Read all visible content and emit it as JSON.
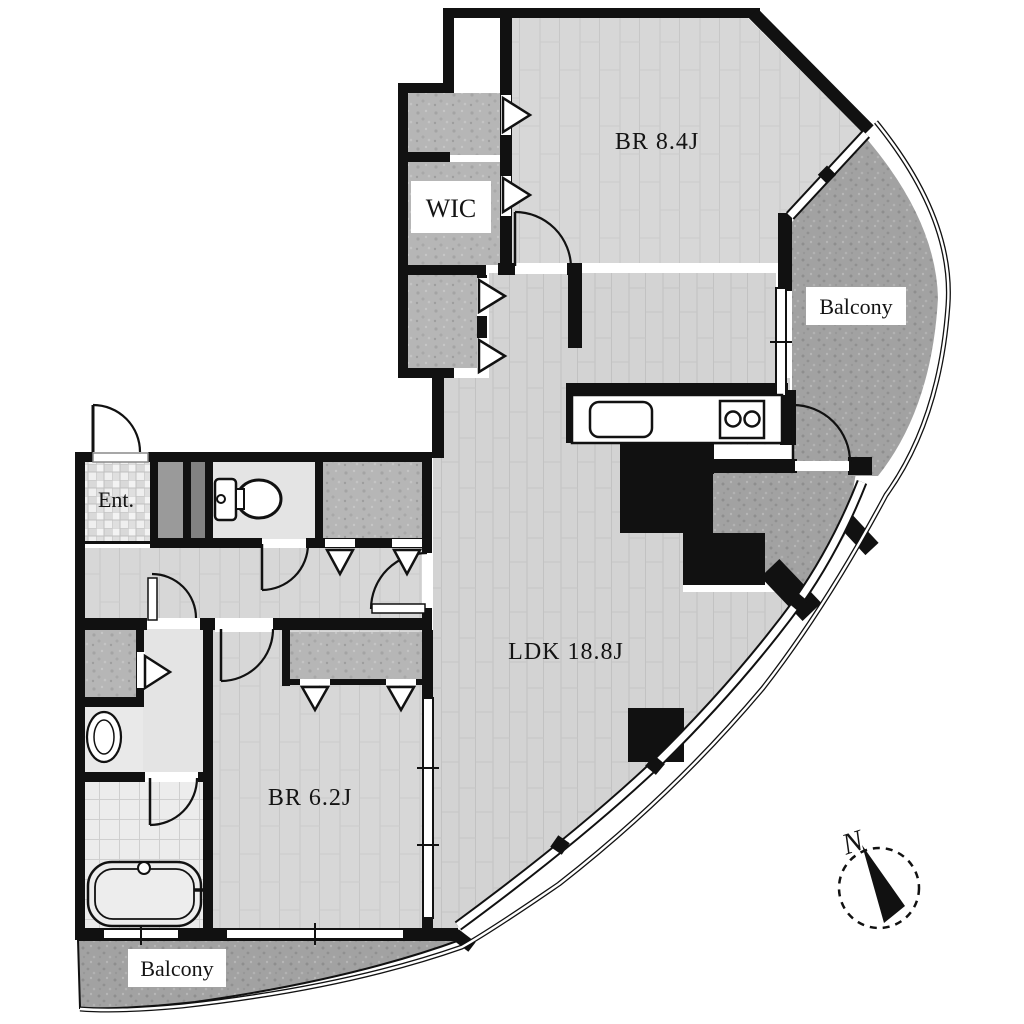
{
  "plan": {
    "type": "apartment-floor-plan",
    "rooms": {
      "bedroom_main": {
        "label": "BR 8.4J"
      },
      "wic": {
        "label": "WIC"
      },
      "balcony_upper": {
        "label": "Balcony"
      },
      "entrance": {
        "label": "Ent."
      },
      "ldk": {
        "label": "LDK 18.8J"
      },
      "bedroom_second": {
        "label": "BR 6.2J"
      },
      "balcony_lower": {
        "label": "Balcony"
      }
    },
    "compass": {
      "north_label": "N"
    },
    "fixtures": [
      "kitchen-counter",
      "kitchen-sink",
      "stove-icon",
      "toilet-icon",
      "washbasin-icon",
      "bathtub-icon",
      "closet-folding-doors",
      "door-swings",
      "window-bands",
      "pillar"
    ],
    "colors": {
      "wall": "#111111",
      "wood_floor": "#d7d7d7",
      "closet_fill": "#b5b5b5",
      "balcony_fill": "#a2a2a2",
      "service_floor": "#e4e4e4",
      "background": "#ffffff"
    }
  }
}
